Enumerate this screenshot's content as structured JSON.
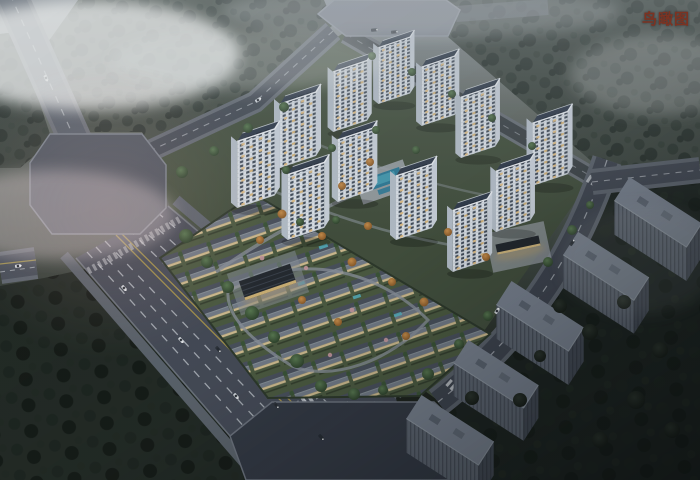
{
  "overlay": {
    "label": "鸟瞰图",
    "label_color": "#7c3322"
  },
  "scene": {
    "type": "architectural-aerial-rendering",
    "time_of_day": "dusk",
    "site": {
      "white_residential_towers": 12,
      "villa_rows": true,
      "context_gray_towers": 5,
      "road_intersections": 3
    },
    "palette": {
      "haze_sky": "#9aa3ab",
      "forest": "#3d4640",
      "dark_ground": "#1b211f",
      "road_asphalt": "#454c57",
      "lane_marking_white": "#cfd5db",
      "lane_marking_yellow": "#b5a04b",
      "tower_facade": "#e2e8ef",
      "tower_roof": "#2f3a4a",
      "villa_roof": "#5a6370",
      "lawn": "#4d5c42",
      "pool_water": "#2f7d9a",
      "window_glow": "#e0c185",
      "context_tower_gray": "#7b8492"
    }
  }
}
